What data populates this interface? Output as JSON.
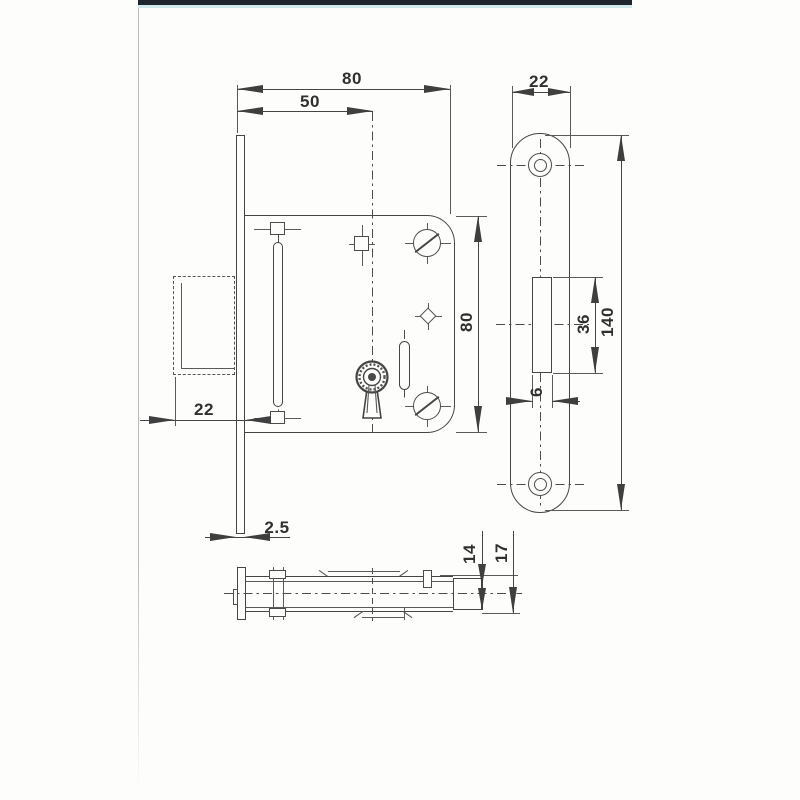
{
  "front_view": {
    "width": "80",
    "backset": "50",
    "height": "80",
    "bolt_offset": "22",
    "faceplate_thickness": "2.5"
  },
  "strike_plate": {
    "width": "22",
    "length": "140",
    "cutout_length": "36",
    "cutout_depth": "6"
  },
  "side_view": {
    "case_thickness": "14",
    "total_thickness": "17"
  },
  "colors": {
    "line": "#454545",
    "label": "#303030",
    "topbar": "#20262e",
    "topbar_accent": "#cfe9ec",
    "paper": "#fdfdfb"
  }
}
